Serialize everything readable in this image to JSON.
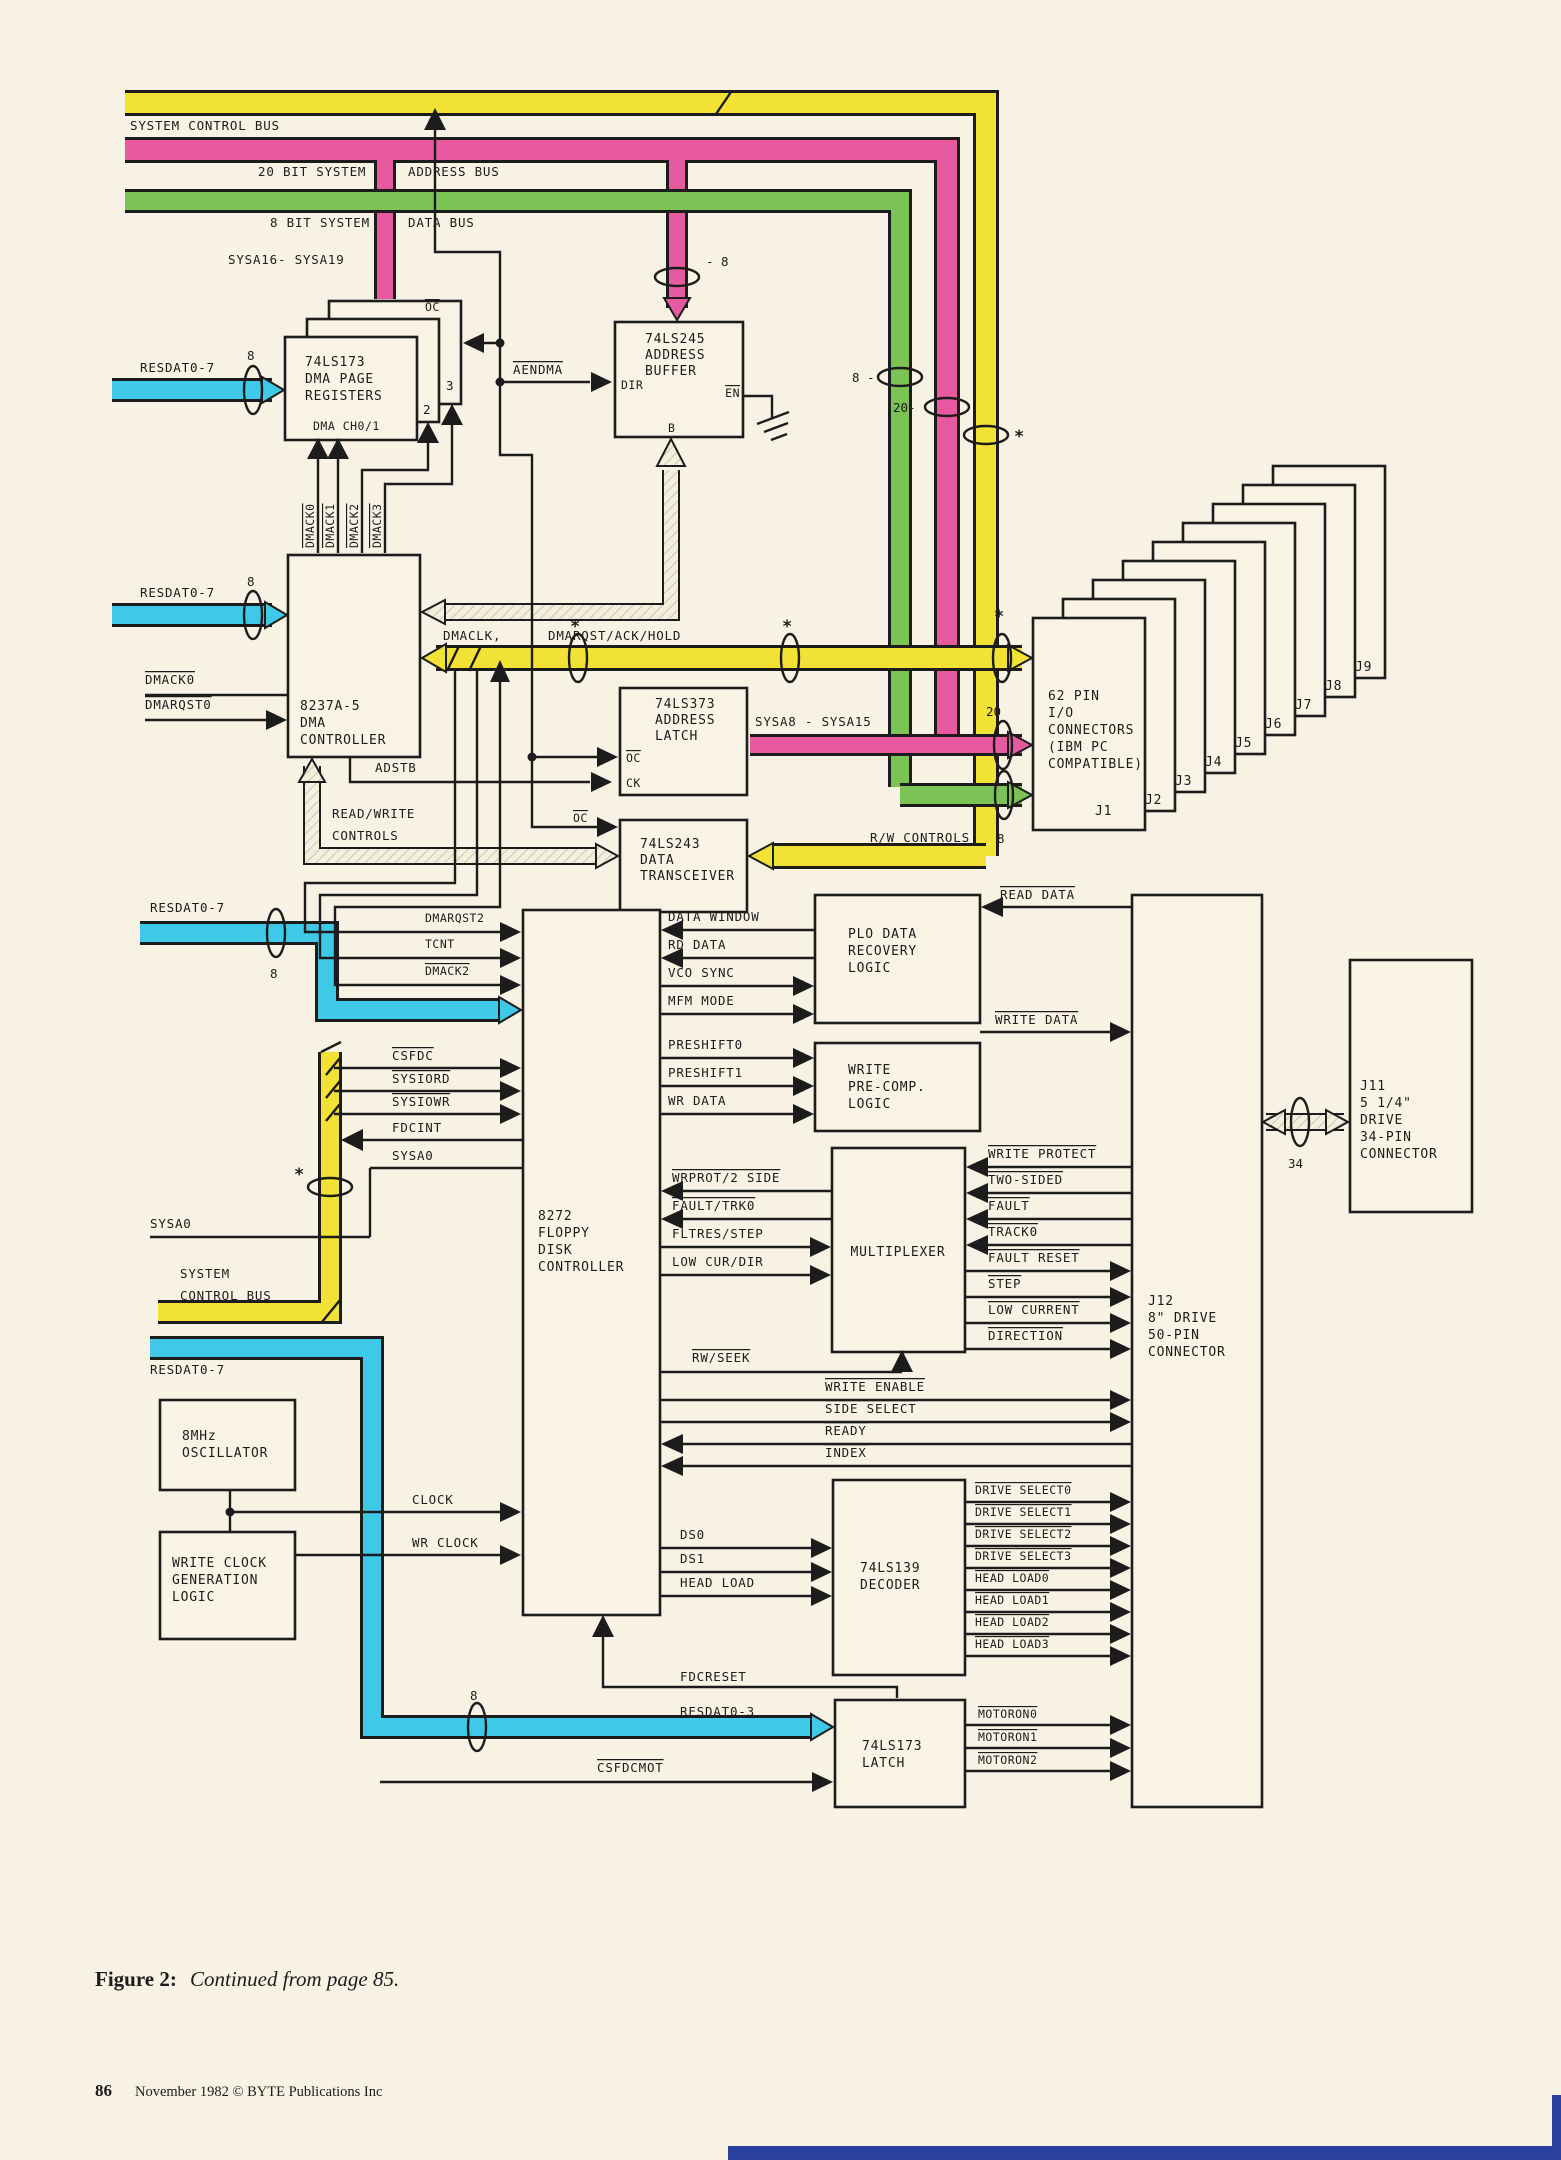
{
  "t": {
    "system_control_bus": "SYSTEM CONTROL BUS",
    "bit20_system": "20 BIT SYSTEM",
    "address_bus": "ADDRESS BUS",
    "bit8_system": "8 BIT SYSTEM",
    "data_bus": "DATA BUS",
    "sysa16_19": "SYSA16- SYSA19",
    "sysa8_15": "SYSA8 - SYSA15",
    "sysa0": "SYSA0",
    "resdat0_7": "RESDAT0-7",
    "resdat0_3": "RESDAT0-3",
    "dmaclk": "DMACLK,",
    "dmarqst_ack_hold": "DMARQST/ACK/HOLD",
    "rw_controls": "R/W CONTROLS",
    "read_write": "READ/WRITE",
    "controls": "CONTROLS",
    "adstb": "ADSTB",
    "aendma": "AENDMA",
    "oc": "OC",
    "ck": "CK",
    "dir": "DIR",
    "en": "EN",
    "b": "B",
    "dmack0": "DMACK0",
    "dmack1": "DMACK1",
    "dmack2": "DMACK2",
    "dmack3": "DMACK3",
    "dmarqst0": "DMARQST0",
    "dmarqst2": "DMARQST2",
    "tcnt": "TCNT",
    "csfdc": "CSFDC",
    "sysiord": "SYSIORD",
    "sysiowr": "SYSIOWR",
    "fdcint": "FDCINT",
    "scb1": "SYSTEM",
    "scb2": "CONTROL BUS",
    "data_window": "DATA WINDOW",
    "rd_data": "RD DATA",
    "vco_sync": "VCO SYNC",
    "mfm_mode": "MFM MODE",
    "read_data": "READ DATA",
    "write_data": "WRITE DATA",
    "preshift0": "PRESHIFT0",
    "preshift1": "PRESHIFT1",
    "wr_data": "WR DATA",
    "wrprot_2side": "WRPROT/2 SIDE",
    "fault_trk0": "FAULT/TRK0",
    "fltres_step": "FLTRES/STEP",
    "low_cur_dir": "LOW CUR/DIR",
    "write_protect": "WRITE PROTECT",
    "two_sided": "TWO-SIDED",
    "fault": "FAULT",
    "track0": "TRACK0",
    "fault_reset": "FAULT RESET",
    "step": "STEP",
    "low_current": "LOW CURRENT",
    "direction": "DIRECTION",
    "rw_seek": "RW/SEEK",
    "write_enable": "WRITE ENABLE",
    "side_select": "SIDE SELECT",
    "ready": "READY",
    "index": "INDEX",
    "clock": "CLOCK",
    "wr_clock": "WR CLOCK",
    "ds0": "DS0",
    "ds1": "DS1",
    "head_load": "HEAD LOAD",
    "drive_select0": "DRIVE SELECT0",
    "drive_select1": "DRIVE SELECT1",
    "drive_select2": "DRIVE SELECT2",
    "drive_select3": "DRIVE SELECT3",
    "head_load0": "HEAD LOAD0",
    "head_load1": "HEAD LOAD1",
    "head_load2": "HEAD LOAD2",
    "head_load3": "HEAD LOAD3",
    "fdcreset": "FDCRESET",
    "csfdcmot": "CSFDCMOT",
    "motoron0": "MOTORON0",
    "motoron1": "MOTORON1",
    "motoron2": "MOTORON2",
    "n2": "2",
    "n3": "3",
    "n8": "8",
    "n8r": "- 8",
    "n8l": "8 -",
    "n20": "20",
    "n20l": "20-",
    "n34": "34",
    "star": "*",
    "j1": "J1",
    "j2": "J2",
    "j3": "J3",
    "j4": "J4",
    "j5": "J5",
    "j6": "J6",
    "j7": "J7",
    "j8": "J8",
    "j9": "J9"
  },
  "blocks": {
    "regs": {
      "l1": "74LS173",
      "l2": "DMA PAGE",
      "l3": "REGISTERS",
      "sub": "DMA CH0/1"
    },
    "buf245": {
      "l1": "74LS245",
      "l2": "ADDRESS",
      "l3": "BUFFER"
    },
    "dma": {
      "l1": "8237A-5",
      "l2": "DMA",
      "l3": "CONTROLLER"
    },
    "latch373": {
      "l1": "74LS373",
      "l2": "ADDRESS",
      "l3": "LATCH"
    },
    "xcvr243": {
      "l1": "74LS243",
      "l2": "DATA",
      "l3": "TRANSCEIVER"
    },
    "fdc": {
      "l1": "8272",
      "l2": "FLOPPY",
      "l3": "DISK",
      "l4": "CONTROLLER"
    },
    "plo": {
      "l1": "PLO DATA",
      "l2": "RECOVERY",
      "l3": "LOGIC"
    },
    "precomp": {
      "l1": "WRITE",
      "l2": "PRE-COMP.",
      "l3": "LOGIC"
    },
    "mux": {
      "l1": "MULTIPLEXER"
    },
    "ioconn": {
      "l1": "62 PIN",
      "l2": "I/O",
      "l3": "CONNECTORS",
      "l4": "(IBM PC",
      "l5": "COMPATIBLE)"
    },
    "dec139": {
      "l1": "74LS139",
      "l2": "DECODER"
    },
    "latch173": {
      "l1": "74LS173",
      "l2": "LATCH"
    },
    "osc": {
      "l1": "8MHz",
      "l2": "OSCILLATOR"
    },
    "wclk": {
      "l1": "WRITE CLOCK",
      "l2": "GENERATION",
      "l3": "LOGIC"
    },
    "j12": {
      "l1": "J12",
      "l2": "8\" DRIVE",
      "l3": "50-PIN",
      "l4": "CONNECTOR"
    },
    "j11": {
      "l1": "J11",
      "l2": "5 1/4\"",
      "l3": "DRIVE",
      "l4": "34-PIN",
      "l5": "CONNECTOR"
    }
  },
  "footer": {
    "fig_label": "Figure 2:",
    "fig_text": "Continued from page 85.",
    "page_num": "86",
    "pub": "November 1982 © BYTE Publications Inc"
  },
  "colors": {
    "paper": "#f7f2e3",
    "ink": "#1c1c1c",
    "yellow": "#f2e235",
    "pink": "#e85aa0",
    "green": "#7cc356",
    "cyan": "#3fc9e8",
    "page_edge_blue": "#2b3f9e"
  }
}
